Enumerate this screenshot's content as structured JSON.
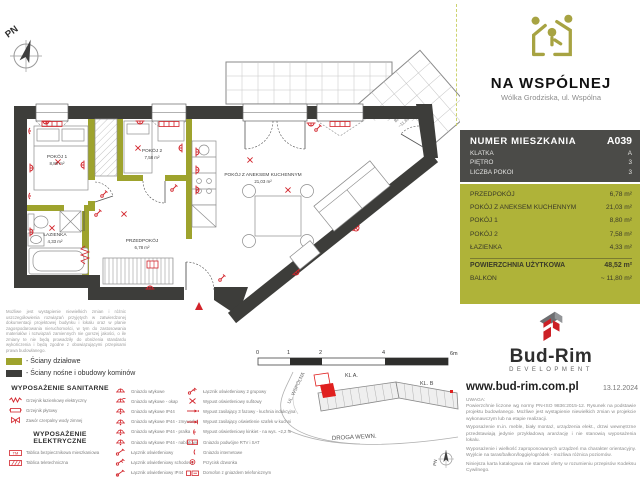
{
  "colors": {
    "olive_panel": "#afb339",
    "olive_wall": "#9ea32d",
    "dark_wall": "#3d3d3a",
    "dark_panel": "#4b4b48",
    "symbol_red": "#d2232a",
    "logo_olive": "#a7a342",
    "brand_red": "#cc2026"
  },
  "compass": {
    "label": "PN"
  },
  "project": {
    "logo_name": "NA WSPÓLNEJ",
    "logo_subtitle": "Wólka Grodziska, ul. Wspólna"
  },
  "unit_header": {
    "title": "NUMER  MIESZKANIA",
    "number": "A039",
    "rows": [
      {
        "label": "KLATKA",
        "value": "A"
      },
      {
        "label": "PIĘTRO",
        "value": "3"
      },
      {
        "label": "LICZBA POKOI",
        "value": "3"
      }
    ]
  },
  "areas": {
    "rooms": [
      {
        "label": "PRZEDPOKÓJ",
        "value": "6,78 m²"
      },
      {
        "label": "POKÓJ Z ANEKSEM KUCHENNYM",
        "value": "21,03 m²"
      },
      {
        "label": "POKÓJ 1",
        "value": "8,80 m²"
      },
      {
        "label": "POKÓJ 2",
        "value": "7,58 m²"
      },
      {
        "label": "ŁAZIENKA",
        "value": "4,33 m²"
      }
    ],
    "total": {
      "label": "POWIERZCHNIA UŻYTKOWA",
      "value": "48,52 m²"
    },
    "balcony": {
      "label": "BALKON",
      "value": "~ 11,80 m²"
    }
  },
  "plan_labels": {
    "room1_name": "POKÓJ 1",
    "room1_area": "8,80 m²",
    "room2_name": "POKÓJ 2",
    "room2_area": "7,58 m²",
    "bath_name": "ŁAZIENKA",
    "bath_area": "4,33 m²",
    "hall_name": "PRZEDPOKÓJ",
    "hall_area": "6,78 m²",
    "living_name": "POKÓJ Z ANEKSEM KUCHENNYM",
    "living_area": "21,03 m²",
    "balcony_name": "BALKON",
    "balcony_area": "~11,80 m²"
  },
  "legend": {
    "disclaimer": "Możliwe jest wystąpienie niewielkich zmian i różnic uszczegółowienia rozwiązań przyjętych w zatwierdzonej dokumentacji projektowej budynku i lokalu oraz w planie zagospodarowania nieruchomości, w tym do zastosowania materiałów i rozwiązań zamiennych nie gorszej jakości, o ile zmiany te nie będą prowadziły do obniżenia standardu wykończenia i będą zgodne z obowiązującymi przepisami prawa budowlanego.",
    "walls": [
      {
        "label": "- Ściany działowe"
      },
      {
        "label": "- Ściany nośne i obudowy kominów"
      }
    ],
    "sanitary_title": "WYPOSAŻENIE SANITARNE",
    "sanitary": [
      "Grzejnik łazienkowy elektryczny",
      "Grzejnik płytowy",
      "Zawór czerpalny wody zimnej"
    ],
    "electrical_title": "WYPOSAŻENIE ELEKTRYCZNE",
    "electrical_panels": [
      {
        "symbol": "TM",
        "label": "Tablica bezpiecznikowa mieszkaniowa"
      },
      {
        "symbol": "TT",
        "label": "Tablica teletechniczna"
      }
    ],
    "electrical_col1": [
      "Gniazdo wtykowe",
      "Gniazdo wtykowe - okap",
      "Gniazdo wtykowe IP44",
      "Gniazdo wtykowe IP44 - zmywarka",
      "Gniazdo wtykowe IP44 - pralka",
      "Gniazdo wtykowe IP44 - nablatowe",
      "Łącznik oświetleniowy",
      "Łącznik oświetleniowy schodowy",
      "Łącznik oświetleniowy IP44"
    ],
    "electrical_col2": [
      "Łącznik oświetleniowy 2 grupowy",
      "Wypust oświetleniowy sufitowy",
      "Wypust zasilający 3 fazowy - kuchnia indukcyjna",
      "Wypust zasilający oświetlenie szafek w kuchni",
      "Wypust oświetleniowy kinkiet - na wys. ~2,2 m",
      "Gniazdo podwójne RTV i SAT",
      "Gniazdo internetowe",
      "Przycisk dzwonka",
      "Domofon z gniazdem telefonicznym"
    ]
  },
  "scalebar": {
    "ticks": [
      "0",
      "1",
      "2",
      "4"
    ],
    "end_label": "6m"
  },
  "siteplan": {
    "stair_a": "KL A.",
    "stair_b": "KL. B",
    "street": "UL. WSPÓLNA",
    "road": "DROGA WEWN.",
    "compass": "PN"
  },
  "developer": {
    "name": "Bud-Rim",
    "subtitle": "DEVELOPMENT",
    "website": "www.bud-rim.com.pl",
    "date": "13.12.2024",
    "note_title": "UWAGA:",
    "note_lines": [
      "Powierzchnie liczone wg normy PN-ISO 9836:2015-12. Rysunek na podstawie projektu budowlanego. Możliwe jest wystąpienie niewielkich zmian w projekcie wykonawczym lub na etapie realizacji.",
      "Wyposażenie m.in. meble, biały montaż, urządzenia elekt., drzwi wewnętrzne przedstawiają jedynie przykładową aranżację i nie stanowią wyposażenia lokalu.",
      "Wyposażenie i wielkość zaproponowanych urządzeń ma charakter orientacyjny. Wyjście na taras/balkon/loggię/ogródek - możliwa różnica poziomów.",
      "Niniejsza karta katalogowa nie stanowi oferty w rozumieniu przepisów Kodeksu Cywilnego."
    ]
  }
}
